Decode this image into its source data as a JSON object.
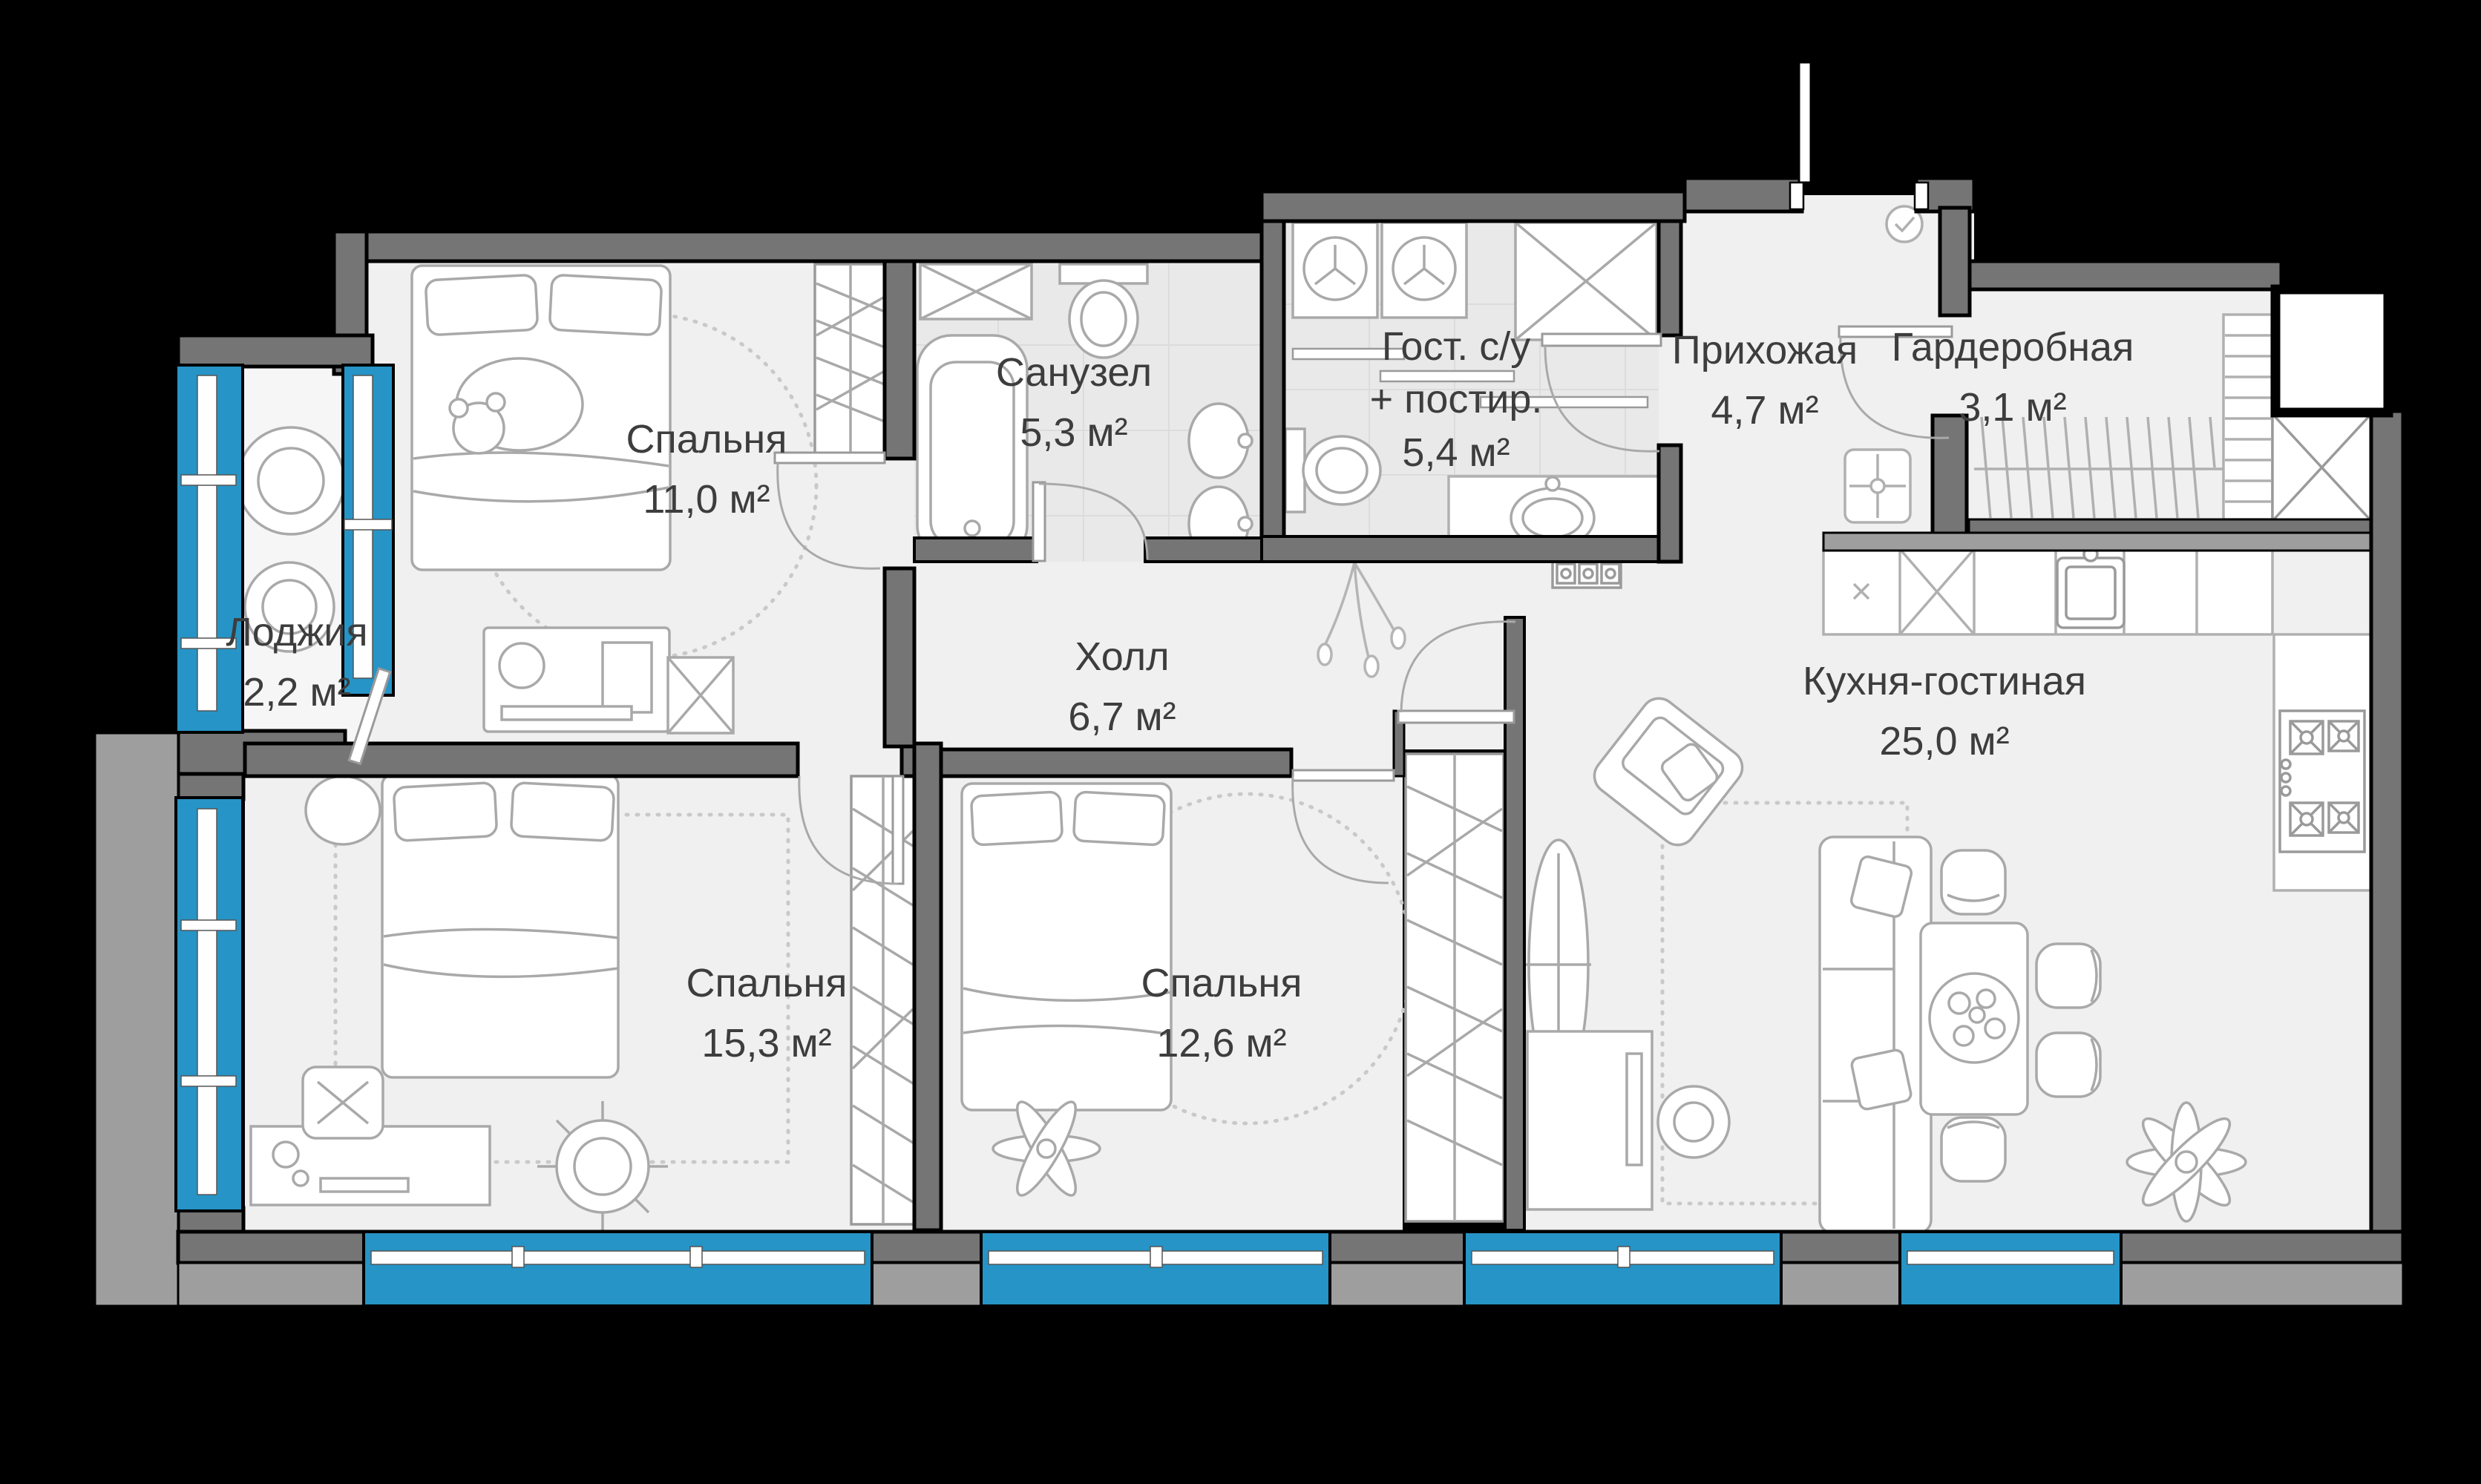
{
  "plan": {
    "type": "apartment-floor-plan",
    "colors": {
      "background": "#000000",
      "floor": "#f0f0f0",
      "tile_floor": "#e9e9e9",
      "wall": "#757575",
      "outer_wall_band": "#9e9e9e",
      "window_glass": "#2694c6",
      "furniture_line": "#a9a9a9",
      "label_text": "#3d3d3d"
    },
    "rooms": [
      {
        "id": "loggia",
        "name": "Лоджия",
        "area": "2,2 м²"
      },
      {
        "id": "bedroom-1",
        "name": "Спальня",
        "area": "11,0 м²"
      },
      {
        "id": "bathroom",
        "name": "Санузел",
        "area": "5,3 м²"
      },
      {
        "id": "guest-bathroom",
        "name": "Гост. с/у + постир.",
        "name_lines": [
          "Гост. с/у",
          "+ постир."
        ],
        "area": "5,4 м²"
      },
      {
        "id": "entry-hall",
        "name": "Прихожая",
        "area": "4,7 м²"
      },
      {
        "id": "wardrobe-room",
        "name": "Гардеробная",
        "area": "3,1 м²"
      },
      {
        "id": "hall",
        "name": "Холл",
        "area": "6,7 м²"
      },
      {
        "id": "bedroom-2",
        "name": "Спальня",
        "area": "15,3 м²"
      },
      {
        "id": "bedroom-3",
        "name": "Спальня",
        "area": "12,6 м²"
      },
      {
        "id": "kitchen-living",
        "name": "Кухня-гостиная",
        "area": "25,0 м²"
      }
    ]
  }
}
